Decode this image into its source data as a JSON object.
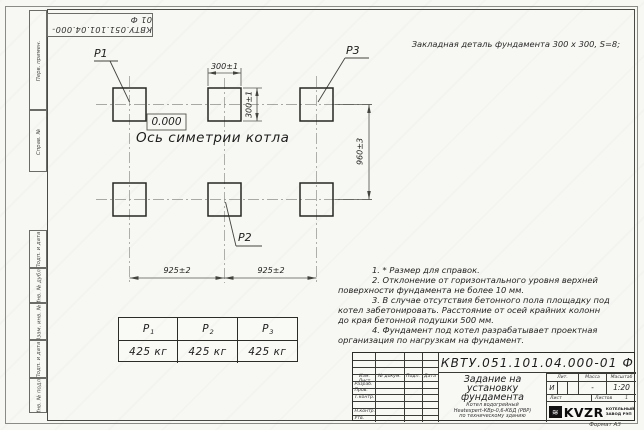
{
  "frame": {
    "doc_number_rotated": "КВТУ.051.101.04.000-01   Ф",
    "stamp_labels": [
      "Перв. примен.",
      "Справ. №",
      "Подп. и дата",
      "Инв. № дубл.",
      "Взам. инв. №",
      "Подп. и дата",
      "Инв. № подл."
    ],
    "format_note": "Формат А3"
  },
  "drawing": {
    "top_note": "Закладная деталь фундамента  300 x 300,  S=8;",
    "elevation_mark": "0.000",
    "axis_label": "Ось симетрии котла",
    "labels": {
      "p1": "Р1",
      "p2": "Р2",
      "p3": "Р3"
    },
    "dims": {
      "pad_width": "300±1",
      "pad_height": "300±1",
      "span_left": "925±2",
      "span_right": "925±2",
      "row_gap": "960±3"
    },
    "notes": [
      "1.  * Размер для справок.",
      "2.  Отклонение от горизонтального уровня верхней поверхности фундамента не более 10 мм.",
      "3.  В случае отсутствия бетонного пола площадку под котел забетонировать. Расстояние от осей крайних колонн до края бетонной подушки 500 мм.",
      "4.  Фундамент под котел разрабатывает проектная организация по нагрузкам на фундамент."
    ]
  },
  "load_table": {
    "columns": [
      {
        "name": "Р",
        "sub": "1",
        "value": "425 кг"
      },
      {
        "name": "Р",
        "sub": "2",
        "value": "425 кг"
      },
      {
        "name": "Р",
        "sub": "3",
        "value": "425 кг"
      }
    ]
  },
  "title_block": {
    "doc_number": "КВТУ.051.101.04.000-01   Ф",
    "title_lines": [
      "Задание на",
      "установку",
      "фундамента"
    ],
    "product_lines": [
      "Котел водогрейный",
      "Heatexpert-КВр-0,6-КБД (РВР)",
      "по техническому зданию"
    ],
    "rev_header": [
      "Изм. Лист",
      "№ докум.",
      "Подп.",
      "Дата"
    ],
    "left_rows": [
      "Разраб.",
      "Пров.",
      "Т.контр.",
      "",
      "Н.контр.",
      "Утв."
    ],
    "lit_header": "Лит.",
    "mass_header": "Масса",
    "scale_header": "Масштаб",
    "lit_value": "И",
    "mass_value": "-",
    "scale_value": "1:20",
    "sheet_label": "Лист",
    "sheets_label": "Листов",
    "sheets_value": "1",
    "logo": {
      "mark": "≋",
      "text": "KVZR",
      "sub1": "КОТЕЛЬНЫЙ",
      "sub2": "ЗАВОД РЭП"
    }
  }
}
